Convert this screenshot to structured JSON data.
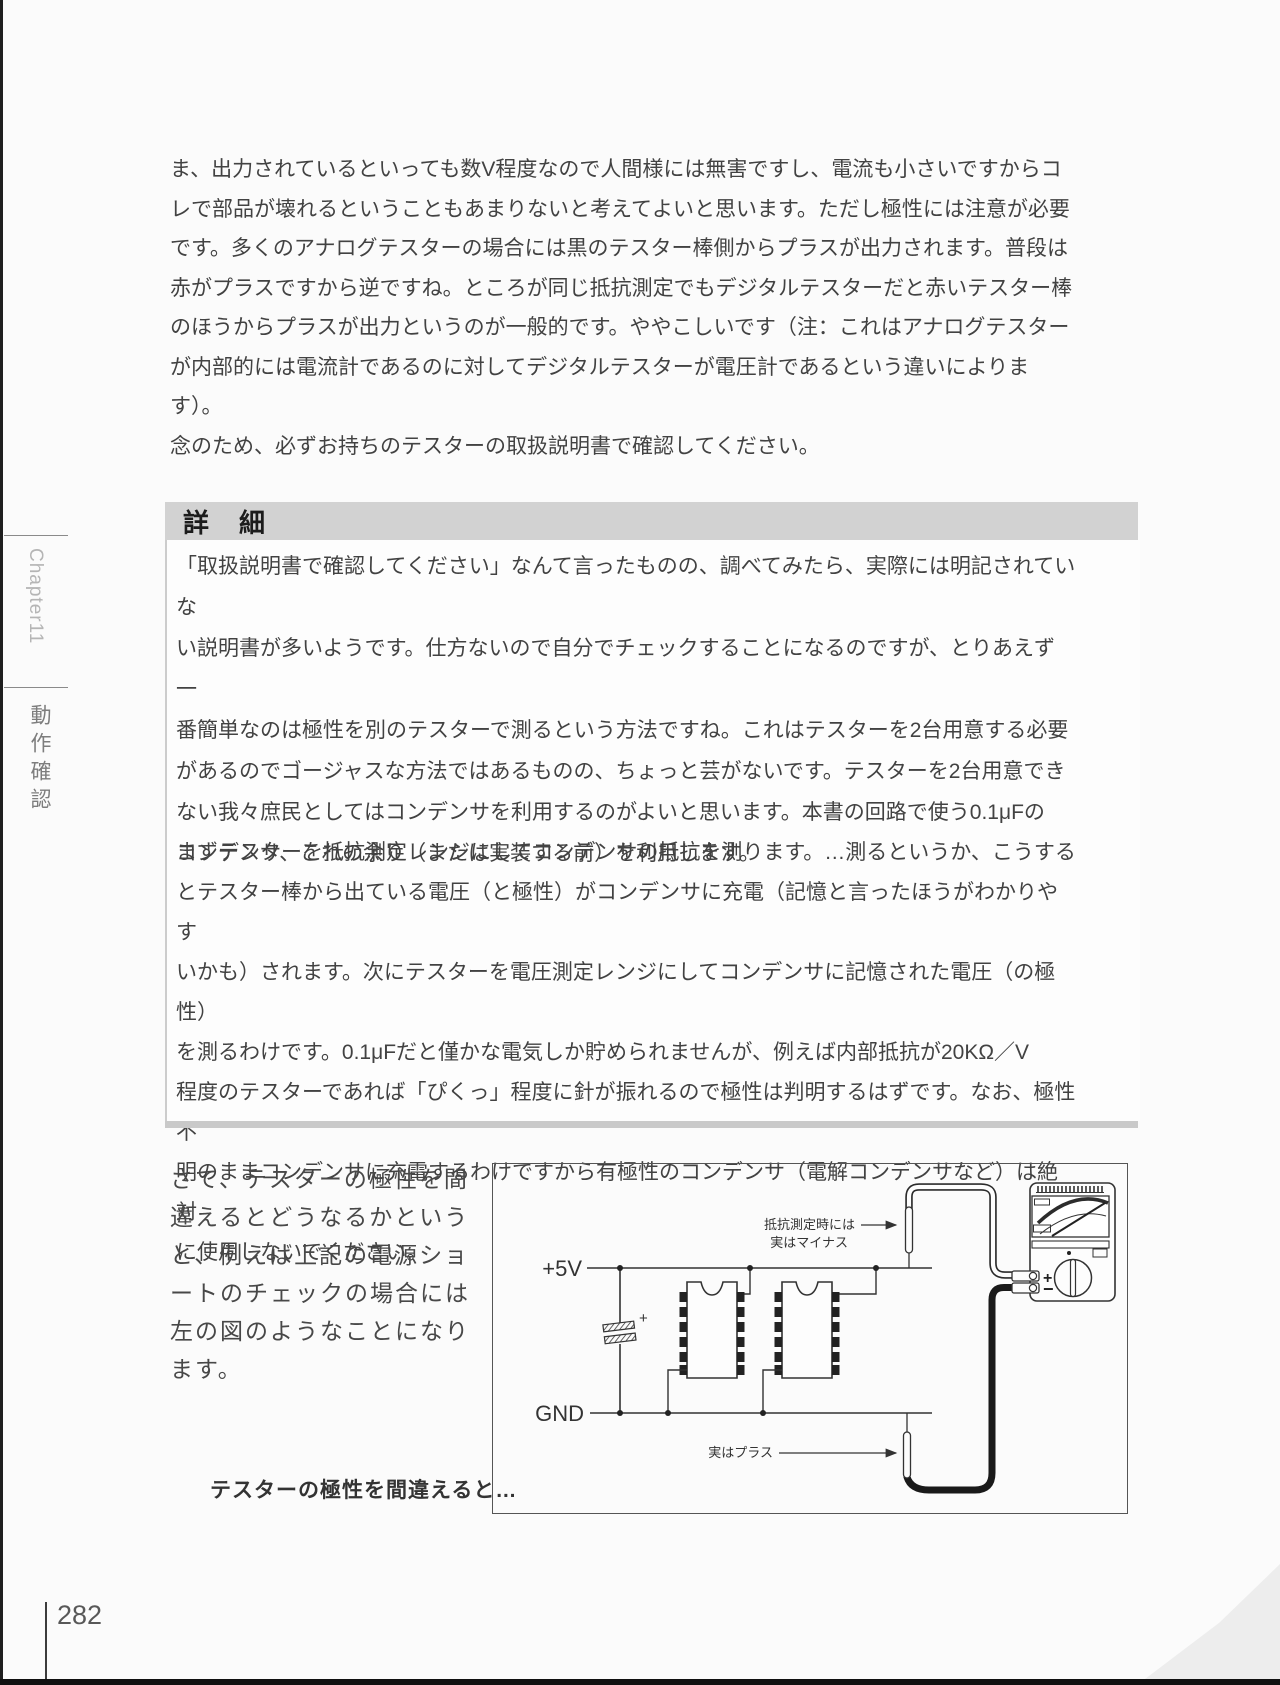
{
  "page": {
    "number": "282",
    "sidebar": {
      "chapter": "Chapter11",
      "section": "動作確認"
    }
  },
  "colors": {
    "detail_header_bg": "#d2d2d2",
    "probe_black_cable": "#1a1a1a",
    "ink": "#3f3f3f"
  },
  "intro": {
    "lines": [
      "ま、出力されているといっても数V程度なので人間様には無害ですし、電流も小さいですからコ",
      "レで部品が壊れるということもあまりないと考えてよいと思います。ただし極性には注意が必要",
      "です。多くのアナログテスターの場合には黒のテスター棒側からプラスが出力されます。普段は",
      "赤がプラスですから逆ですね。ところが同じ抵抗測定でもデジタルテスターだと赤いテスター棒",
      "のほうからプラスが出力というのが一般的です。ややこしいです（注：これはアナログテスター",
      "が内部的には電流計であるのに対してデジタルテスターが電圧計であるという違いによります）。",
      "念のため、必ずお持ちのテスターの取扱説明書で確認してください。"
    ]
  },
  "detail_box": {
    "header": "詳　細",
    "para1_lines": [
      "「取扱説明書で確認してください」なんて言ったものの、調べてみたら、実際には明記されていな",
      "い説明書が多いようです。仕方ないので自分でチェックすることになるのですが、とりあえず一",
      "番簡単なのは極性を別のテスターで測るという方法ですね。これはテスターを2台用意する必要",
      "があるのでゴージャスな方法ではあるものの、ちょっと芸がないです。テスターを2台用意でき",
      "ない我々庶民としてはコンデンサを利用するのがよいと思います。本書の回路で使う0.1μFの",
      "コンデンサ、これの余り（または実装する前）を利用します。"
    ],
    "para2_lines": [
      "まずテスターを抵抗測定レンジにしてコンデンサの抵抗を測ります。…測るというか、こうする",
      "とテスター棒から出ている電圧（と極性）がコンデンサに充電（記憶と言ったほうがわかりやす",
      "いかも）されます。次にテスターを電圧測定レンジにしてコンデンサに記憶された電圧（の極性）",
      "を測るわけです。0.1μFだと僅かな電気しか貯められませんが、例えば内部抵抗が20KΩ／V",
      "程度のテスターであれば「ぴくっ」程度に針が振れるので極性は判明するはずです。なお、極性不",
      "明のままコンデンサに充電するわけですから有極性のコンデンサ（電解コンデンサなど）は絶対",
      "に使用しないでください。"
    ]
  },
  "bottom": {
    "side_lines": [
      "さて、テスターの極性を間",
      "違えるとどうなるかという",
      "と、例えば上記の電源ショ",
      "ートのチェックの場合には",
      "左の図のようなことになり",
      "ます。"
    ],
    "caption": "テスターの極性を間違えると…"
  },
  "figure": {
    "labels": {
      "vcc": "+5V",
      "gnd": "GND",
      "cap_plus": "+",
      "note_red_line1": "抵抗測定時には",
      "note_red_line2": "実はマイナス",
      "note_black": "実はプラス",
      "terminal_plus": "+",
      "terminal_minus": "−"
    }
  }
}
